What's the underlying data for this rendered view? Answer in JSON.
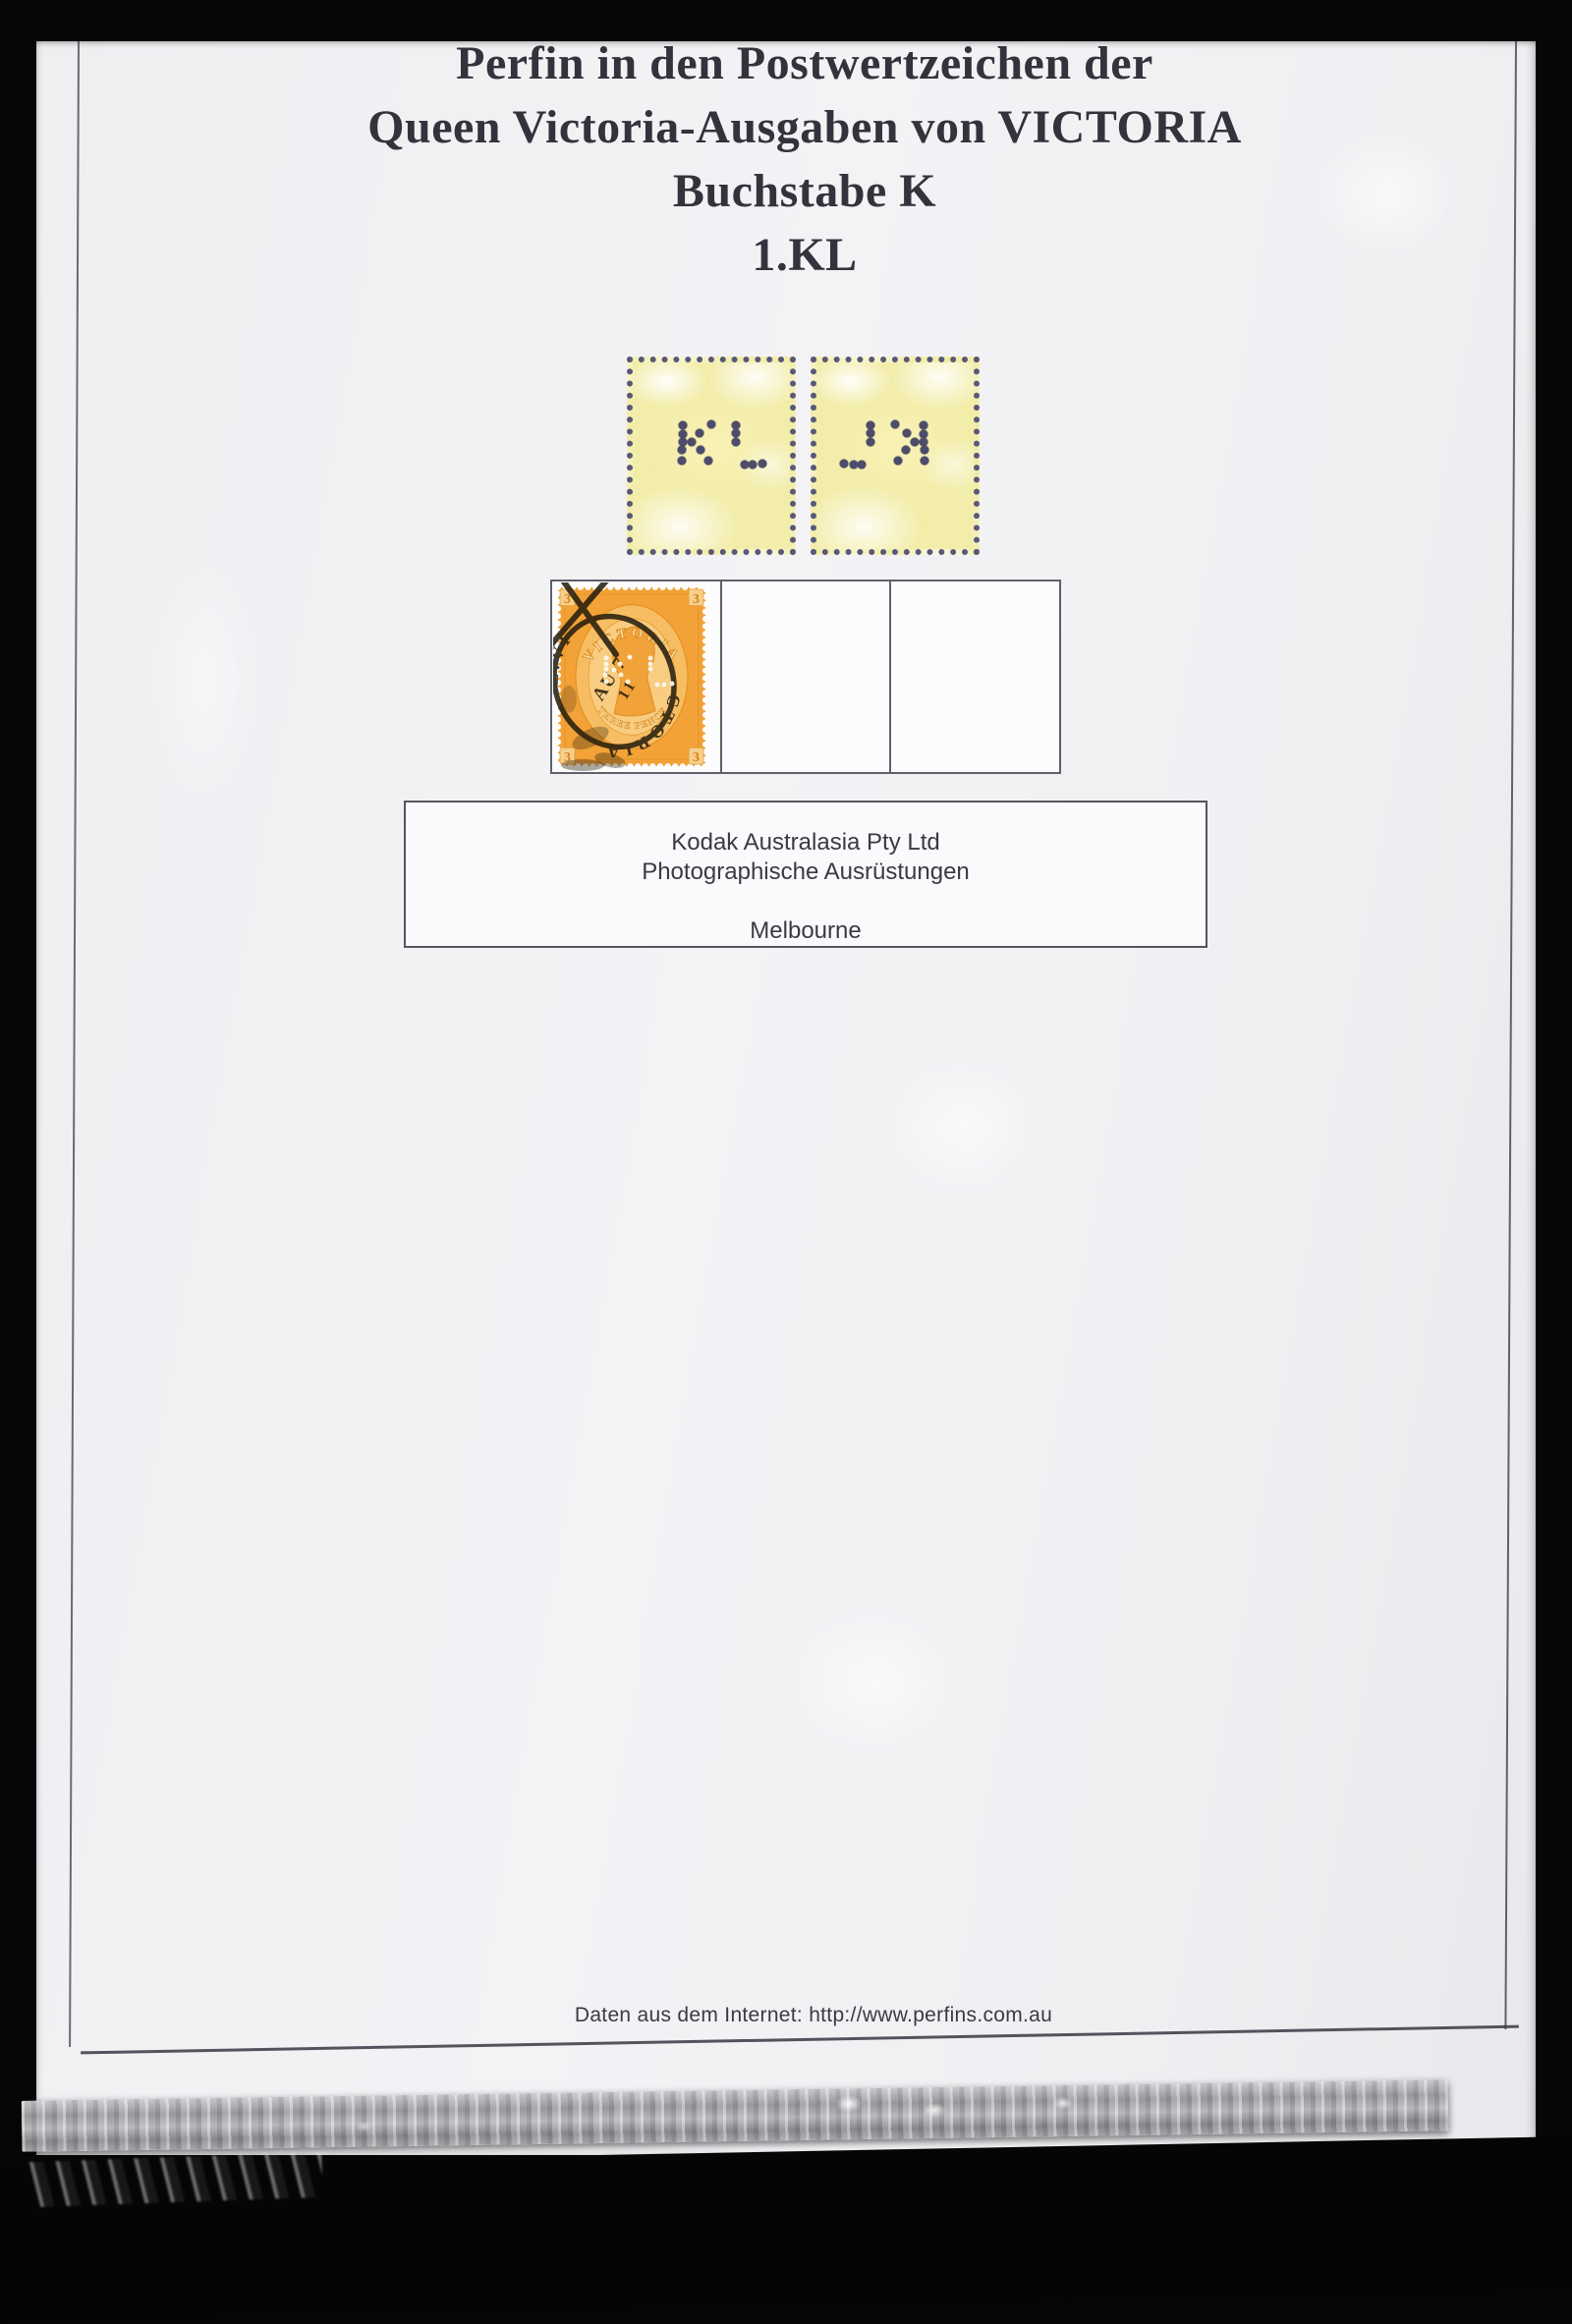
{
  "album_page": {
    "title_lines": [
      "Perfin in den Postwertzeichen der",
      "Queen Victoria-Ausgaben von VICTORIA",
      "Buchstabe K",
      "1.KL"
    ],
    "footer_text": "Daten aus dem Internet: http://www.perfins.com.au"
  },
  "perfin": {
    "letters": "KL",
    "variants": [
      "front",
      "back-mirrored"
    ],
    "dot_color": "#4d4d6b",
    "paper_color": "#f3edaa",
    "dots": [
      [
        31.8,
        33.5
      ],
      [
        31.8,
        38.2
      ],
      [
        31.6,
        42.5
      ],
      [
        31.2,
        47.0
      ],
      [
        31.5,
        52.5
      ],
      [
        37.6,
        42.8
      ],
      [
        42.4,
        38.0
      ],
      [
        50.0,
        33.2
      ],
      [
        42.9,
        47.0
      ],
      [
        48.2,
        52.5
      ],
      [
        65.9,
        33.5
      ],
      [
        65.9,
        38.0
      ],
      [
        65.9,
        42.5
      ],
      [
        71.2,
        54.5
      ],
      [
        76.5,
        54.5
      ],
      [
        82.3,
        54.0
      ]
    ]
  },
  "stamp": {
    "top_text": "VICTORIA",
    "corner_numeral": "3",
    "bottom_text": "THREE PENCE",
    "body_color": "#f2a237",
    "postmark": {
      "arc_text_upper": "E.VI",
      "arc_text_lower": "CTORIA",
      "date_line": "AU 7",
      "year_line": "11",
      "ink_color": "#221a0c"
    }
  },
  "company_box": {
    "lines": [
      "Kodak Australasia Pty Ltd",
      "Photographische Ausrüstungen",
      "Melbourne"
    ]
  },
  "colors": {
    "surround": "#060606",
    "page": "#f0f0f3",
    "frame_line": "#42424c",
    "title_text": "#33333d",
    "body_text": "#3a3a42",
    "cell_border": "#60606a"
  }
}
